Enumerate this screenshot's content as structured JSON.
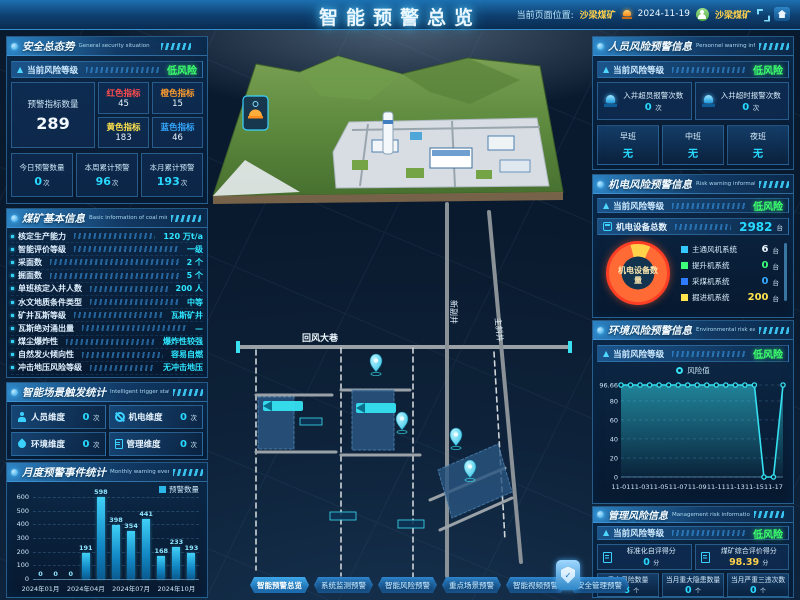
{
  "header": {
    "title": "智能预警总览",
    "location_label": "当前页面位置:",
    "location_value": "沙梁煤矿",
    "date": "2024-11-19",
    "user_name": "沙梁煤矿"
  },
  "left": {
    "security": {
      "title": "安全总态势",
      "subtitle": "General security situation",
      "risk_label": "当前风险等级",
      "risk_value": "低风险",
      "total_label": "预警指标数量",
      "total_value": "289",
      "indicators": [
        {
          "label": "红色指标",
          "value": "45",
          "color": "#ff4d4d"
        },
        {
          "label": "橙色指标",
          "value": "15",
          "color": "#ff9c2e"
        },
        {
          "label": "黄色指标",
          "value": "183",
          "color": "#ffe44d"
        },
        {
          "label": "蓝色指标",
          "value": "46",
          "color": "#35a8ff"
        }
      ],
      "stats": [
        {
          "label": "今日预警数量",
          "value": "0",
          "unit": "次"
        },
        {
          "label": "本周累计预警",
          "value": "96",
          "unit": "次"
        },
        {
          "label": "本月累计预警",
          "value": "193",
          "unit": "次"
        }
      ]
    },
    "mine_info": {
      "title": "煤矿基本信息",
      "subtitle": "Basic information of coal mine",
      "rows": [
        {
          "label": "核定生产能力",
          "value": "120 万t/a"
        },
        {
          "label": "智能评价等级",
          "value": "一级"
        },
        {
          "label": "采面数",
          "value": "2 个"
        },
        {
          "label": "掘面数",
          "value": "5 个"
        },
        {
          "label": "单班核定入井人数",
          "value": "200 人"
        },
        {
          "label": "水文地质条件类型",
          "value": "中等"
        },
        {
          "label": "矿井瓦斯等级",
          "value": "瓦斯矿井"
        },
        {
          "label": "瓦斯绝对涌出量",
          "value": "—"
        },
        {
          "label": "煤尘爆炸性",
          "value": "爆炸性较强"
        },
        {
          "label": "自然发火倾向性",
          "value": "容易自燃"
        },
        {
          "label": "冲击地压风险等级",
          "value": "无冲击地压"
        }
      ]
    },
    "trigger": {
      "title": "智能场景触发统计",
      "subtitle": "Intelligent trigger statistics",
      "items": [
        {
          "label": "人员维度",
          "value": "0",
          "unit": "次",
          "icon": "person-icon"
        },
        {
          "label": "机电维度",
          "value": "0",
          "unit": "次",
          "icon": "gear-icon"
        },
        {
          "label": "环境维度",
          "value": "0",
          "unit": "次",
          "icon": "drop-icon"
        },
        {
          "label": "管理维度",
          "value": "0",
          "unit": "次",
          "icon": "clipboard-icon"
        }
      ]
    },
    "monthly": {
      "title": "月度预警事件统计",
      "subtitle": "Monthly warning event statistics",
      "legend": "预警数量"
    }
  },
  "right": {
    "personnel": {
      "title": "人员风险预警信息",
      "subtitle": "Personnel warning information",
      "risk_label": "当前风险等级",
      "risk_value": "低风险",
      "alarms": [
        {
          "label": "入井超员报警次数",
          "value": "0",
          "unit": "次"
        },
        {
          "label": "入井超时报警次数",
          "value": "0",
          "unit": "次"
        }
      ],
      "shifts": [
        {
          "label": "早班",
          "value": "无"
        },
        {
          "label": "中班",
          "value": "无"
        },
        {
          "label": "夜班",
          "value": "无"
        }
      ]
    },
    "mech": {
      "title": "机电风险预警信息",
      "subtitle": "Risk warning information",
      "risk_label": "当前风险等级",
      "risk_value": "低风险",
      "total_label": "机电设备总数",
      "total_value": "2982",
      "total_unit": "台",
      "donut_center": "机电设备数量",
      "legend": [
        {
          "label": "主通风机系统",
          "value": "6",
          "unit": "台",
          "color": "#35c8ff",
          "value_color": "#eaf6ff"
        },
        {
          "label": "提升机系统",
          "value": "0",
          "unit": "台",
          "color": "#3dff7a",
          "value_color": "#3dff7a"
        },
        {
          "label": "采煤机系统",
          "value": "0",
          "unit": "台",
          "color": "#2f7bff",
          "value_color": "#35a8ff"
        },
        {
          "label": "掘进机系统",
          "value": "200",
          "unit": "台",
          "color": "#ffe44d",
          "value_color": "#ffe44d"
        }
      ]
    },
    "env": {
      "title": "环境风险预警信息",
      "subtitle": "Environmental risk early warning",
      "risk_label": "当前风险等级",
      "risk_value": "低风险",
      "legend": "风险值"
    },
    "mgmt": {
      "title": "管理风险信息",
      "subtitle": "Management risk information",
      "risk_label": "当前风险等级",
      "risk_value": "低风险",
      "scores": [
        {
          "label": "标准化自评得分",
          "value": "0",
          "unit": "分",
          "value_color": "#27d9ff"
        },
        {
          "label": "煤矿综合评价得分",
          "value": "98.39",
          "unit": "分",
          "value_color": "#ffd24a"
        }
      ],
      "stats": [
        {
          "label": "重大风险数量",
          "value": "38",
          "unit": "个"
        },
        {
          "label": "当月重大隐患数量",
          "value": "0",
          "unit": "个"
        },
        {
          "label": "当月严重三违次数",
          "value": "0",
          "unit": "个"
        }
      ]
    }
  },
  "map": {
    "tunnel_label": "回风大巷",
    "shaft_labels": [
      "新副井",
      "主斜井"
    ]
  },
  "nav_buttons": [
    {
      "label": "智能预警总览",
      "active": true
    },
    {
      "label": "系统监测预警",
      "active": false
    },
    {
      "label": "智能风险预警",
      "active": false
    },
    {
      "label": "重点场景预警",
      "active": false
    },
    {
      "label": "智能视频预警",
      "active": false
    },
    {
      "label": "安全管理预警",
      "active": false
    }
  ],
  "chart_data": [
    {
      "type": "bar",
      "title": "月度预警事件统计",
      "categories": [
        "2024年01月",
        "2024年02月",
        "2024年03月",
        "2024年04月",
        "2024年05月",
        "2024年06月",
        "2024年07月",
        "2024年08月",
        "2024年09月",
        "2024年10月",
        "2024年11月"
      ],
      "values": [
        0,
        0,
        0,
        191,
        598,
        398,
        354,
        441,
        168,
        233,
        193
      ],
      "shown_x_ticks": [
        "2024年01月",
        "2024年04月",
        "2024年07月",
        "2024年10月"
      ],
      "shown_x_tick_indices": [
        0,
        3,
        6,
        9
      ],
      "ylim": [
        0,
        600
      ],
      "yticks": [
        0,
        100,
        200,
        300,
        400,
        500,
        600
      ],
      "legend": [
        "预警数量"
      ],
      "bar_color": "#2bb7e8"
    },
    {
      "type": "pie",
      "title": "机电设备数量",
      "series": [
        {
          "name": "主通风机系统",
          "value": 6
        },
        {
          "name": "提升机系统",
          "value": 0
        },
        {
          "name": "采煤机系统",
          "value": 0
        },
        {
          "name": "掘进机系统",
          "value": 200
        }
      ],
      "total": 2982,
      "ring_colors": {
        "main": "#ff6a35",
        "slice": "#ffd24a"
      }
    },
    {
      "type": "line",
      "title": "环境风险值趋势",
      "legend": [
        "风险值"
      ],
      "x": [
        "11-01",
        "11-02",
        "11-03",
        "11-04",
        "11-05",
        "11-06",
        "11-07",
        "11-08",
        "11-09",
        "11-10",
        "11-11",
        "11-12",
        "11-13",
        "11-14",
        "11-15",
        "11-16",
        "11-17",
        "11-18"
      ],
      "values": [
        96.66,
        96.66,
        96.66,
        96.66,
        96.66,
        96.66,
        96.66,
        96.66,
        96.66,
        96.66,
        96.66,
        96.66,
        96.66,
        96.66,
        96.66,
        0,
        0,
        96.66
      ],
      "shown_x_ticks": [
        "11-01",
        "11-03",
        "11-05",
        "11-07",
        "11-09",
        "11-11",
        "11-13",
        "11-15",
        "11-17"
      ],
      "yticks": [
        0,
        20,
        40,
        60,
        80,
        96.66
      ],
      "ylim": [
        0,
        100
      ],
      "line_color": "#35e0f0"
    }
  ]
}
